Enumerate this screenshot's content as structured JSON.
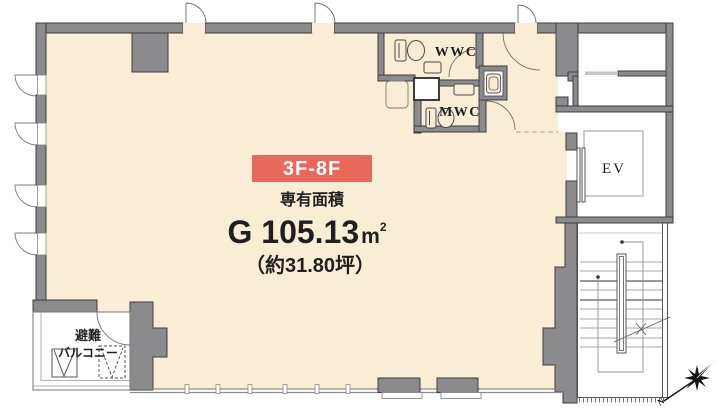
{
  "badge": {
    "label": "3F-8F",
    "bg_color": "#E8695B",
    "text_color": "#FFFFFF"
  },
  "area": {
    "heading": "専有面積",
    "value": "G 105.13",
    "unit_m": "m",
    "unit_sup": "2",
    "full_value": "G 105.13㎡",
    "tsubo": "（約31.80坪）"
  },
  "rooms": {
    "wwc": "WWC",
    "mwc": "MWC",
    "ev": "EV"
  },
  "balcony": {
    "line1": "避難",
    "line2": "バルコニー"
  },
  "compass": {
    "n": "N"
  },
  "colors": {
    "floor": "#FAEDD5",
    "wall": "#8B8B8E",
    "wall_outline": "#3D3D3F",
    "white": "#FFFFFF",
    "accent": "#E8695B",
    "text": "#1F1F1F"
  }
}
